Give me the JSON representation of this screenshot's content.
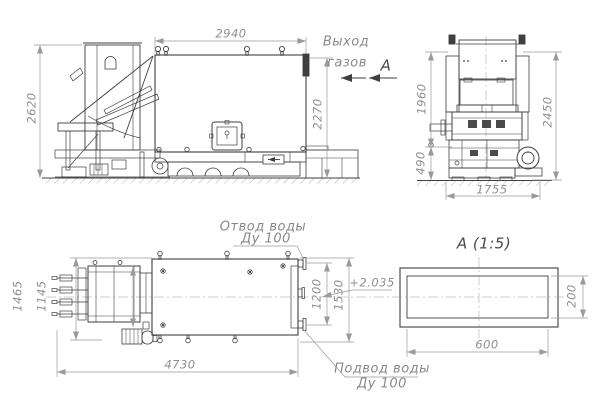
{
  "drawing_labels": {
    "side_view": {
      "dim_top": "2940",
      "dim_left": "2620",
      "dim_right": "2270",
      "gas_outlet_line1": "Выход",
      "gas_outlet_line2": "газов",
      "view_marker": "А"
    },
    "front_view": {
      "dim_upper": "1960",
      "dim_total": "2450",
      "dim_base": "490",
      "dim_width": "1755"
    },
    "plan_view": {
      "dim_left_outer": "1465",
      "dim_left_inner": "1145",
      "dim_length": "4730",
      "dim_right_inner": "1200",
      "dim_right_outer": "1530",
      "water_outlet_line1": "Отвод воды",
      "water_outlet_line2": "Ду 100",
      "water_supply_line1": "Подвод воды",
      "water_supply_line2": "Ду 100"
    },
    "section_view": {
      "title": "А  (1:5)",
      "level_mark": "+2.035",
      "dim_width": "600",
      "dim_height": "200"
    }
  },
  "colors": {
    "outline": "#3f3f3f",
    "dimension": "#9a9a9a",
    "background": "#ffffff"
  }
}
